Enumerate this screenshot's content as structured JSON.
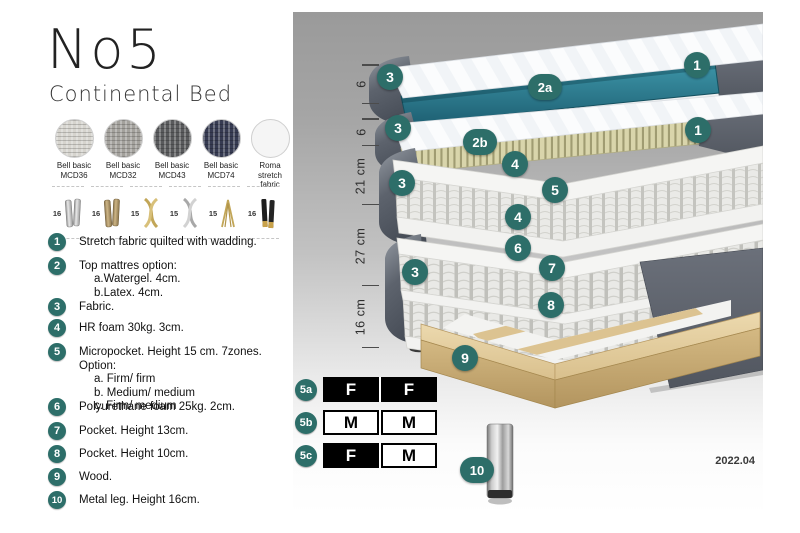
{
  "header": {
    "title": "No5",
    "subtitle": "Continental Bed"
  },
  "swatches": [
    {
      "name": "Bell basic",
      "code": "MCD36",
      "color": "#d6d4ce"
    },
    {
      "name": "Bell basic",
      "code": "MCD32",
      "color": "#a3a19c"
    },
    {
      "name": "Bell basic",
      "code": "MCD43",
      "color": "#595a5c"
    },
    {
      "name": "Bell basic",
      "code": "MCD74",
      "color": "#363b52"
    },
    {
      "name": "Roma",
      "code": "stretch fabric",
      "color": "#f5f5f5"
    }
  ],
  "legs": [
    {
      "size": "16",
      "icon": "leg-cylinder-silver"
    },
    {
      "size": "16",
      "icon": "leg-cylinder-bronze"
    },
    {
      "size": "15",
      "icon": "leg-twist-gold"
    },
    {
      "size": "15",
      "icon": "leg-twist-silver"
    },
    {
      "size": "15",
      "icon": "leg-hairpin-gold"
    },
    {
      "size": "16",
      "icon": "leg-cylinder-black-gold"
    }
  ],
  "legend": {
    "items": [
      {
        "num": "1",
        "text": "Stretch fabric quilted with wadding.",
        "subs": []
      },
      {
        "num": "2",
        "text": "Top mattres option:",
        "subs": [
          "a.Watergel. 4cm.",
          "b.Latex. 4cm."
        ]
      },
      {
        "num": "3",
        "text": "Fabric.",
        "subs": []
      },
      {
        "num": "4",
        "text": "HR foam 30kg. 3cm.",
        "subs": []
      },
      {
        "num": "5",
        "text": "Micropocket. Height 15 cm. 7zones. Option:",
        "subs": [
          "a. Firm/ firm",
          "b. Medium/ medium",
          "c. Firm/ medium"
        ]
      },
      {
        "num": "6",
        "text": "Polyurethane foam 25kg. 2cm.",
        "subs": []
      },
      {
        "num": "7",
        "text": "Pocket. Height 13cm.",
        "subs": []
      },
      {
        "num": "8",
        "text": "Pocket. Height 10cm.",
        "subs": []
      },
      {
        "num": "9",
        "text": "Wood.",
        "subs": []
      },
      {
        "num": "10",
        "text": "Metal leg. Height 16cm.",
        "subs": []
      }
    ]
  },
  "scale": {
    "labels": [
      "6",
      "6",
      "21 cm",
      "27 cm",
      "16 cm"
    ]
  },
  "diagram": {
    "badges": {
      "b1a": "1",
      "b1b": "1",
      "b2a": "2a",
      "b2b": "2b",
      "b3a": "3",
      "b3b": "3",
      "b3c": "3",
      "b3d": "3",
      "b4a": "4",
      "b4b": "4",
      "b5": "5",
      "b6": "6",
      "b7": "7",
      "b8": "8",
      "b9": "9",
      "b10": "10"
    }
  },
  "firmness": {
    "rows": [
      {
        "id": "5a",
        "cells": [
          "F",
          "F"
        ]
      },
      {
        "id": "5b",
        "cells": [
          "M",
          "M"
        ]
      },
      {
        "id": "5c",
        "cells": [
          "F",
          "M"
        ]
      }
    ]
  },
  "version": "2022.04",
  "colors": {
    "badge": "#2d6e69",
    "teal_core": "#2a7f92",
    "fabric_gray": "#5a606b",
    "wood": "#ddc391"
  }
}
